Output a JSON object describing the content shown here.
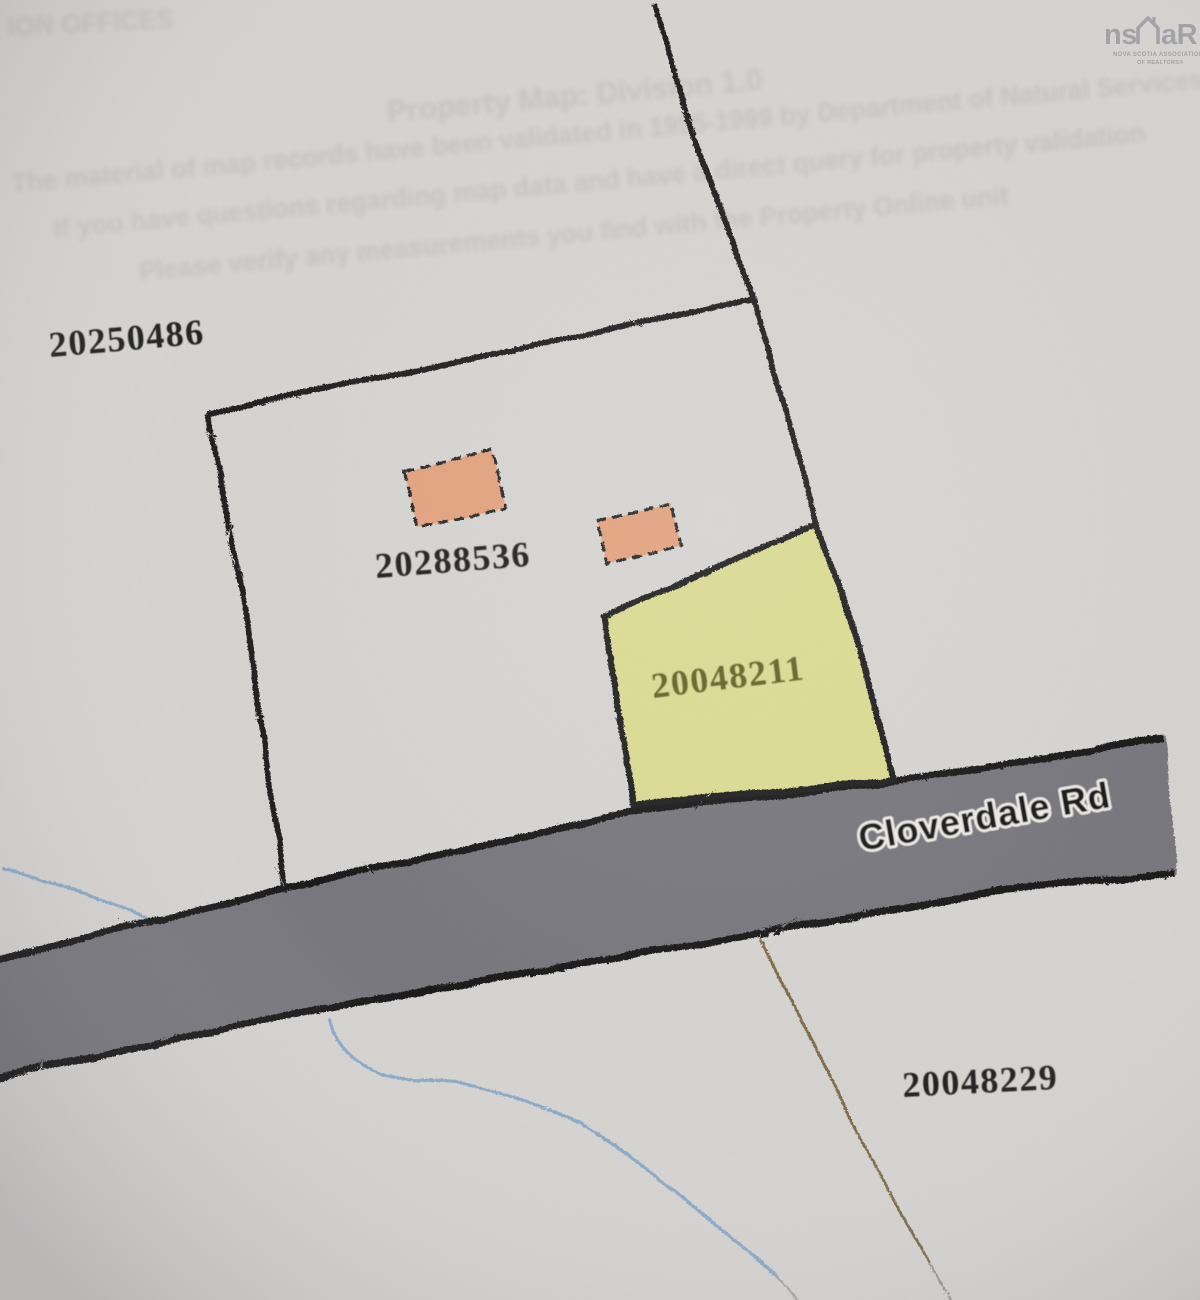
{
  "parcels": [
    {
      "pid": "20250486",
      "highlighted": false
    },
    {
      "pid": "20288536",
      "highlighted": false
    },
    {
      "pid": "20048211",
      "highlighted": true
    },
    {
      "pid": "20048229",
      "highlighted": false
    }
  ],
  "road": {
    "label": "Cloverdale Rd"
  },
  "buildings": {
    "count": 2
  },
  "ghost_text": {
    "corner": "ION OFFICES",
    "heading": "Property Map: Division 1.0",
    "line1": "The material of map records have been validated in 1995-1999 by Department of Natural Services at",
    "line2": "If you have questions regarding map data and have a direct query for property validation",
    "line3": "Please verify any measurements you find with the Property Online unit"
  },
  "logo": {
    "word_left": "ns",
    "word_right": "aR",
    "sub_line1": "NOVA SCOTIA ASSOCIATION",
    "sub_line2": "OF REALTORS®"
  },
  "colors": {
    "paper": "#d6d4d1",
    "boundary_line": "#1d1d1d",
    "highlight_parcel_fill": "#dadb90",
    "highlight_parcel_text": "#5e5e22",
    "building_fill": "#e3a17c",
    "road_fill": "#76757b",
    "road_edge": "#141414",
    "stream": "#8aa9c6",
    "trail": "#7d6a4a",
    "parcel_label": "#1c1c1c",
    "road_label": "#141414",
    "logo_gray": "#9b9ba0"
  }
}
